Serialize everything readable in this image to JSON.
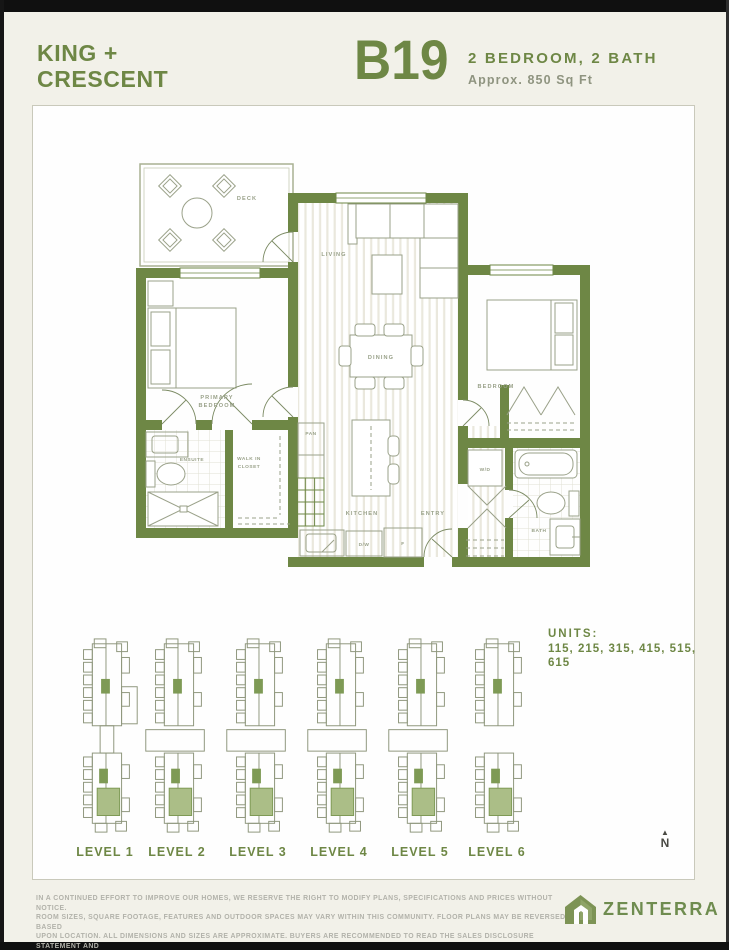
{
  "header": {
    "project_name_line1": "KING +",
    "project_name_line2": "CRESCENT",
    "plan_code": "B19",
    "plan_spec": "2 BEDROOM, 2 BATH",
    "plan_area": "Approx. 850 Sq Ft"
  },
  "plan": {
    "rooms": {
      "deck": "DECK",
      "living": "LIVING",
      "dining": "DINING",
      "kitchen": "KITCHEN",
      "entry": "ENTRY",
      "primary_line1": "PRIMARY",
      "primary_line2": "BEDROOM",
      "ensuite": "ENSUITE",
      "walkin_line1": "WALK IN",
      "walkin_line2": "CLOSET",
      "pantry": "PAN",
      "bedroom": "BEDROOM",
      "washer_dryer": "W/D",
      "bath": "BATH",
      "dishwasher": "D/W",
      "fridge": "F"
    }
  },
  "levels": {
    "items": [
      {
        "label": "LEVEL 1"
      },
      {
        "label": "LEVEL 2"
      },
      {
        "label": "LEVEL 3"
      },
      {
        "label": "LEVEL 4"
      },
      {
        "label": "LEVEL 5"
      },
      {
        "label": "LEVEL 6"
      }
    ],
    "units_label": "UNITS:",
    "units_value": "115, 215, 315, 415, 515, 615",
    "north_label": "N"
  },
  "icons": {
    "north_arrow": "▲"
  },
  "footer": {
    "disclaimer_lines": [
      "IN A CONTINUED EFFORT TO IMPROVE OUR HOMES, WE RESERVE THE RIGHT TO MODIFY PLANS, SPECIFICATIONS AND PRICES WITHOUT NOTICE.",
      "ROOM SIZES, SQUARE FOOTAGE, FEATURES AND OUTDOOR SPACES MAY VARY WITHIN THIS COMMUNITY. FLOOR PLANS MAY BE REVERSED BASED",
      "UPON LOCATION. ALL DIMENSIONS AND SIZES ARE APPROXIMATE. BUYERS ARE RECOMMENDED TO READ THE SALES DISCLOSURE STATEMENT AND",
      "REVIEW THE ARCHITECTURAL PLANS PRIOR TO PURCHASE. E.&O.E."
    ],
    "brand": "ZENTERRA"
  },
  "colors": {
    "accent_green": "#6e8745",
    "unit_highlight": "#abbe87",
    "background": "#f2f1e9",
    "sheet": "#fefefe"
  }
}
